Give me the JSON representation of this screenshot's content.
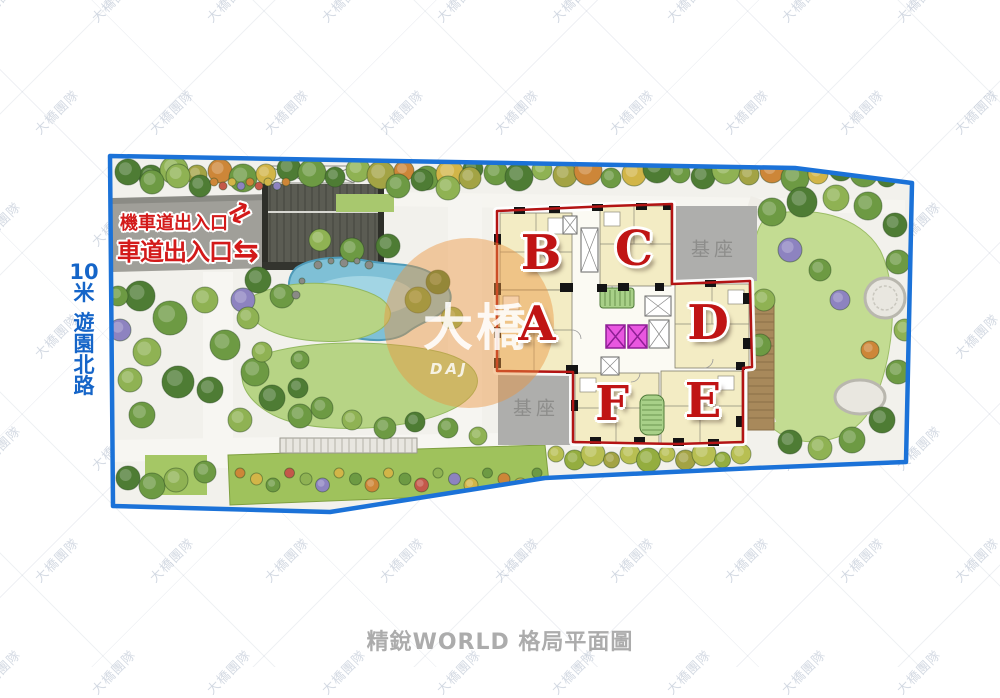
{
  "caption": "精銳WORLD 格局平面圖",
  "street": {
    "chars": [
      "10",
      "米",
      "遊",
      "園",
      "北",
      "路"
    ]
  },
  "entrances": {
    "moto": "機車道出入口",
    "moto_arrows": "⇄",
    "car": "車道出入口",
    "car_arrows": "⇆"
  },
  "building": {
    "units": {
      "a": "A",
      "b": "B",
      "c": "C",
      "d": "D",
      "e": "E",
      "f": "F"
    },
    "base_top": "基座",
    "base_bottom": "基座"
  },
  "watermark": {
    "tile": "大橋團隊",
    "logo": "大橋",
    "logo_sub": "DAJ"
  },
  "colors": {
    "boundary_blue": "#1b72d8",
    "outline_red": "#b31414",
    "unit_letter_red": "#c01414",
    "entrance_red": "#d31a1a",
    "street_blue": "#1565c8",
    "caption_gray": "#acacac",
    "logo_orange": "#ec943e",
    "base_gray": "#aeaeac"
  }
}
